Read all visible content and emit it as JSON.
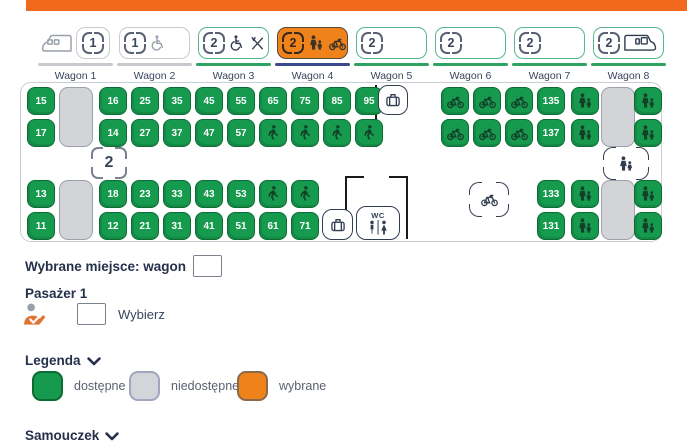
{
  "topbar": {
    "color": "#F2691D"
  },
  "wagons": [
    {
      "id": 1,
      "label": "Wagon 1",
      "badge": "1",
      "icons_before": [
        "train-head"
      ],
      "icons_after": [],
      "state": "inactive"
    },
    {
      "id": 2,
      "label": "Wagon 2",
      "badge": "1",
      "icons_after": [
        "wheelchair"
      ],
      "state": "inactive"
    },
    {
      "id": 3,
      "label": "Wagon 3",
      "badge": "2",
      "icons_after": [
        "wheelchair",
        "restaurant"
      ],
      "state": "available"
    },
    {
      "id": 4,
      "label": "Wagon 4",
      "badge": "2",
      "icons_after": [
        "family",
        "bike"
      ],
      "state": "selected"
    },
    {
      "id": 5,
      "label": "Wagon 5",
      "badge": "2",
      "icons_after": [],
      "state": "available"
    },
    {
      "id": 6,
      "label": "Wagon 6",
      "badge": "2",
      "icons_after": [],
      "state": "available"
    },
    {
      "id": 7,
      "label": "Wagon 7",
      "badge": "2",
      "icons_after": [],
      "state": "available"
    },
    {
      "id": 8,
      "label": "Wagon 8",
      "badge": "2",
      "icons_after": [
        "train-tail"
      ],
      "state": "available"
    }
  ],
  "seatmap": {
    "class_badge": "2",
    "wc_label": "WC",
    "seats": [
      {
        "n": "15",
        "x": 6,
        "y": 4
      },
      {
        "n": "16",
        "x": 78,
        "y": 4
      },
      {
        "n": "25",
        "x": 110,
        "y": 4
      },
      {
        "n": "35",
        "x": 142,
        "y": 4
      },
      {
        "n": "45",
        "x": 174,
        "y": 4
      },
      {
        "n": "55",
        "x": 206,
        "y": 4
      },
      {
        "n": "65",
        "x": 238,
        "y": 4
      },
      {
        "n": "75",
        "x": 270,
        "y": 4
      },
      {
        "n": "85",
        "x": 302,
        "y": 4
      },
      {
        "n": "95",
        "x": 334,
        "y": 4
      },
      {
        "icon": "bike",
        "x": 420,
        "y": 4
      },
      {
        "icon": "bike",
        "x": 452,
        "y": 4
      },
      {
        "icon": "bike",
        "x": 484,
        "y": 4
      },
      {
        "n": "135",
        "x": 516,
        "y": 4
      },
      {
        "icon": "family",
        "x": 550,
        "y": 4
      },
      {
        "icon": "family",
        "x": 613,
        "y": 4
      },
      {
        "n": "17",
        "x": 6,
        "y": 36
      },
      {
        "n": "14",
        "x": 78,
        "y": 36
      },
      {
        "n": "27",
        "x": 110,
        "y": 36
      },
      {
        "n": "37",
        "x": 142,
        "y": 36
      },
      {
        "n": "47",
        "x": 174,
        "y": 36
      },
      {
        "n": "57",
        "x": 206,
        "y": 36
      },
      {
        "icon": "walker",
        "x": 238,
        "y": 36
      },
      {
        "icon": "walker",
        "x": 270,
        "y": 36
      },
      {
        "icon": "walker",
        "x": 302,
        "y": 36
      },
      {
        "icon": "walker",
        "x": 334,
        "y": 36
      },
      {
        "icon": "bike",
        "x": 420,
        "y": 36
      },
      {
        "icon": "bike",
        "x": 452,
        "y": 36
      },
      {
        "icon": "bike",
        "x": 484,
        "y": 36
      },
      {
        "n": "137",
        "x": 516,
        "y": 36
      },
      {
        "icon": "family",
        "x": 550,
        "y": 36
      },
      {
        "icon": "family",
        "x": 613,
        "y": 36
      },
      {
        "n": "13",
        "x": 6,
        "y": 97
      },
      {
        "n": "18",
        "x": 78,
        "y": 97
      },
      {
        "n": "23",
        "x": 110,
        "y": 97
      },
      {
        "n": "33",
        "x": 142,
        "y": 97
      },
      {
        "n": "43",
        "x": 174,
        "y": 97
      },
      {
        "n": "53",
        "x": 206,
        "y": 97
      },
      {
        "icon": "walker",
        "x": 238,
        "y": 97
      },
      {
        "icon": "walker",
        "x": 270,
        "y": 97
      },
      {
        "n": "133",
        "x": 516,
        "y": 97
      },
      {
        "icon": "family",
        "x": 550,
        "y": 97
      },
      {
        "icon": "family",
        "x": 613,
        "y": 97
      },
      {
        "n": "11",
        "x": 6,
        "y": 129
      },
      {
        "n": "12",
        "x": 78,
        "y": 129
      },
      {
        "n": "21",
        "x": 110,
        "y": 129
      },
      {
        "n": "31",
        "x": 142,
        "y": 129
      },
      {
        "n": "41",
        "x": 174,
        "y": 129
      },
      {
        "n": "51",
        "x": 206,
        "y": 129
      },
      {
        "n": "61",
        "x": 238,
        "y": 129
      },
      {
        "n": "71",
        "x": 270,
        "y": 129
      },
      {
        "n": "131",
        "x": 516,
        "y": 129
      },
      {
        "icon": "family",
        "x": 550,
        "y": 129
      },
      {
        "icon": "family",
        "x": 613,
        "y": 129
      }
    ],
    "doors": [
      {
        "x": 38,
        "y": 4
      },
      {
        "x": 38,
        "y": 97
      },
      {
        "x": 580,
        "y": 4
      },
      {
        "x": 580,
        "y": 97
      }
    ],
    "facilities": [
      {
        "name": "luggage-rack",
        "icon": "luggage",
        "style": "box",
        "x": 357,
        "y": 2,
        "w": 30,
        "h": 30
      },
      {
        "name": "luggage-rack",
        "icon": "luggage",
        "style": "box",
        "x": 301,
        "y": 126,
        "w": 31,
        "h": 31
      },
      {
        "name": "toilet",
        "icon": "wc",
        "style": "box",
        "label": "WC",
        "x": 335,
        "y": 123,
        "w": 44,
        "h": 34
      },
      {
        "name": "bike-storage",
        "icon": "bike",
        "style": "brackets",
        "x": 448,
        "y": 99,
        "w": 40,
        "h": 35
      },
      {
        "name": "family-area",
        "icon": "family",
        "style": "brackets",
        "x": 582,
        "y": 64,
        "w": 46,
        "h": 33
      }
    ],
    "walls": [
      {
        "x": 354,
        "y": 2,
        "w": 2,
        "h": 62
      },
      {
        "x": 341,
        "y": 62,
        "w": 15,
        "h": 2
      },
      {
        "x": 324,
        "y": 93,
        "w": 2,
        "h": 63
      },
      {
        "x": 324,
        "y": 93,
        "w": 19,
        "h": 2
      },
      {
        "x": 385,
        "y": 93,
        "w": 2,
        "h": 63
      },
      {
        "x": 368,
        "y": 93,
        "w": 19,
        "h": 2
      }
    ]
  },
  "selection": {
    "label": "Wybrane miejsce: wagon",
    "value": ""
  },
  "passenger": {
    "title": "Pasażer 1",
    "action_label": "Wybierz",
    "value": ""
  },
  "legend": {
    "title": "Legenda",
    "items": [
      {
        "state": "available",
        "label": "dostępne"
      },
      {
        "state": "unavailable",
        "label": "niedostępne"
      },
      {
        "state": "selected",
        "label": "wybrane"
      }
    ]
  },
  "tutorial": {
    "title": "Samouczek"
  },
  "colors": {
    "accent": "#F2691D",
    "available": "#169A4D",
    "available_border": "#0B6B33",
    "unavailable": "#D3D5DA",
    "unavailable_border": "#9FA6BE",
    "selected": "#F0821C",
    "selected_border": "#8A6A4A",
    "navy": "#333D52"
  }
}
